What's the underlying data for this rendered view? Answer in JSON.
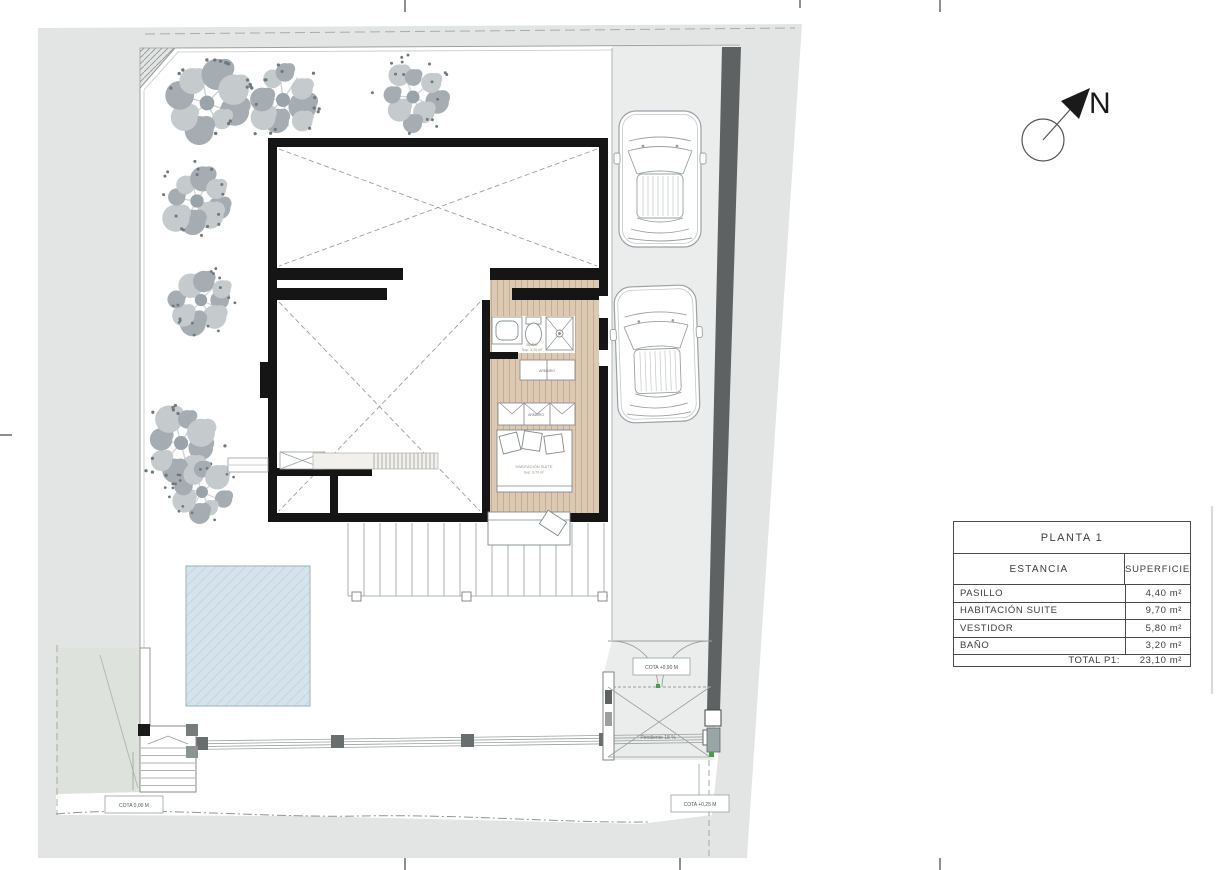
{
  "table": {
    "title": "PLANTA 1",
    "col_estancia": "ESTANCIA",
    "col_superficie": "SUPERFICIE",
    "rows": [
      {
        "estancia": "PASILLO",
        "superficie": "4,40 m²"
      },
      {
        "estancia": "HABITACIÓN SUITE",
        "superficie": "9,70 m²"
      },
      {
        "estancia": "VESTIDOR",
        "superficie": "5,80 m²"
      },
      {
        "estancia": "BAÑO",
        "superficie": "3,20 m²"
      }
    ],
    "total_label": "TOTAL P1:",
    "total_value": "23,10 m²"
  },
  "compass": {
    "label": "N"
  },
  "plan_labels": {
    "cota_ground": "COTA 0,00 M",
    "cota_street": "COTA +0,25 M",
    "cota_gate": "COTA +0,90 M",
    "pendiente": "Pendiente 18 %",
    "bano_name": "BAÑO",
    "bano_sup": "Sup: 3,20 m²",
    "suite_name": "HABITACIÓN SUITE",
    "suite_sup": "Sup: 9,70 m²",
    "armario_1": "ARMARIO",
    "armario_2": "ARMARIO"
  },
  "colors": {
    "site_gray": "#e3e5e4",
    "driveway_gray": "#ebedec",
    "boundary_wall_dark": "#5e6262",
    "neighbor_green_gray": "#dde2dd",
    "wood_floor": "#dbc9b3",
    "pool_blue": "#d5e3ec",
    "wall_black": "#151515",
    "marker_green": "#4a9b4a"
  }
}
